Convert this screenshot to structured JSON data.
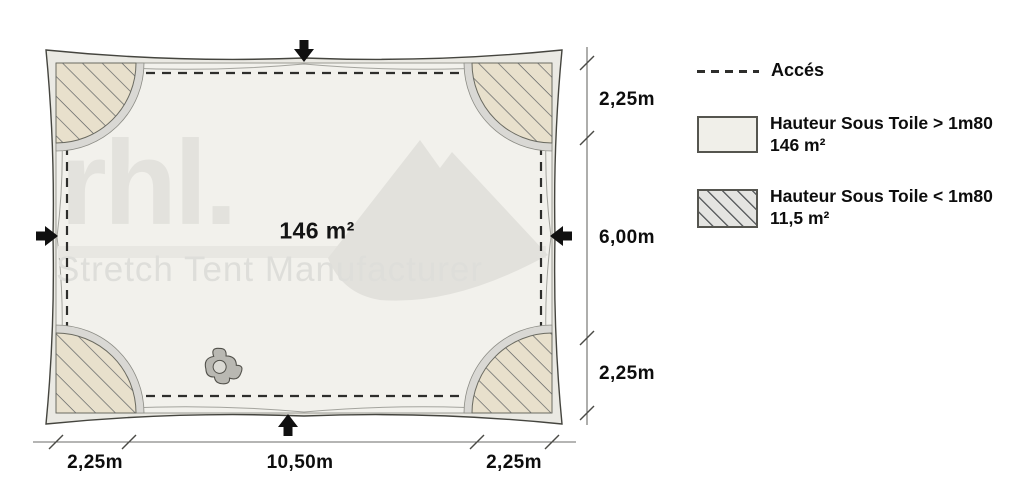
{
  "plan": {
    "area_label": "146 m²",
    "dims_right": [
      "2,25m",
      "6,00m",
      "2,25m"
    ],
    "dims_bottom": [
      "2,25m",
      "10,50m",
      "2,25m"
    ],
    "watermark_brand": "rhl.",
    "watermark_tagline": "Stretch Tent Manufacturer"
  },
  "legend": {
    "access_label": "Accés",
    "over_label_line1": "Hauteur Sous Toile > 1m80",
    "over_label_line2": "146 m²",
    "under_label_line1": "Hauteur Sous Toile < 1m80",
    "under_label_line2": "11,5 m²"
  },
  "colors": {
    "canvas_fill": "#f2f1ec",
    "border_band": "#eae9e3",
    "wedge_beige": "#e8e0cc",
    "wedge_gray": "#d9d8d4",
    "hatch_line": "#5e6163",
    "access_dash": "#2e2e2c",
    "dimension_line": "#6b6b68",
    "label_text": "#0d0d0d",
    "watermark_gray": "#e3e2dd"
  }
}
